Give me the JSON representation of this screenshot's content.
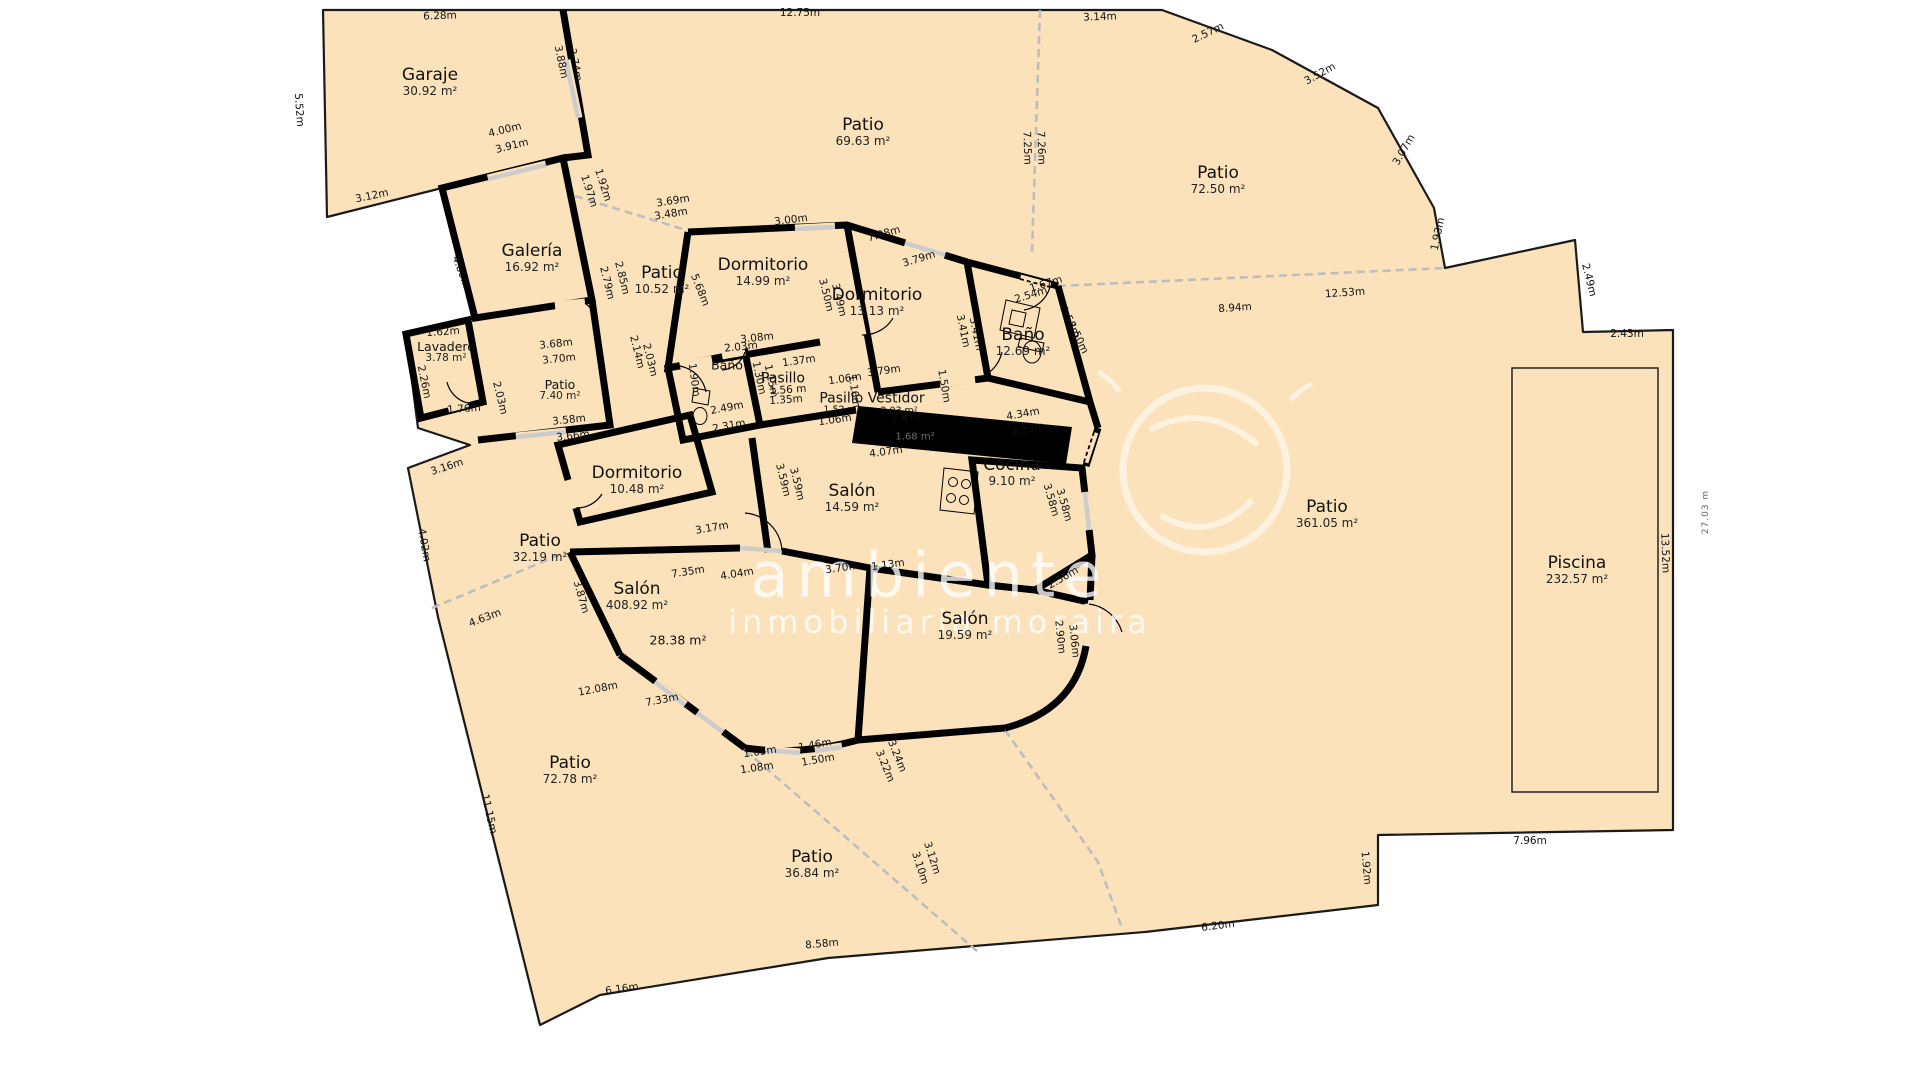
{
  "title": "floor-plan",
  "colors": {
    "parcel_fill": "#fbe2bb",
    "boundary": "#1a1a1a",
    "wall": "#000000",
    "divider_dashed": "#bdbdbd",
    "opening": "#cccccc",
    "watermark": "rgba(255,255,255,0.78)"
  },
  "watermark": {
    "line1": "ambiente",
    "line2": "inmobiliaria moraira"
  },
  "side_ruler": "27.03 m",
  "rooms": [
    {
      "name": "Garaje",
      "area": "30.92 m²",
      "x": 430,
      "y": 82,
      "s": ""
    },
    {
      "name": "Patio",
      "area": "69.63 m²",
      "x": 863,
      "y": 132,
      "s": ""
    },
    {
      "name": "Patio",
      "area": "72.50 m²",
      "x": 1218,
      "y": 180,
      "s": ""
    },
    {
      "name": "Galería",
      "area": "16.92 m²",
      "x": 532,
      "y": 258,
      "s": ""
    },
    {
      "name": "Patio",
      "area": "10.52 m²",
      "x": 662,
      "y": 280,
      "s": ""
    },
    {
      "name": "Dormitorio",
      "area": "14.99 m²",
      "x": 763,
      "y": 272,
      "s": ""
    },
    {
      "name": "Dormitorio",
      "area": "13.13 m²",
      "x": 877,
      "y": 302,
      "s": ""
    },
    {
      "name": "Baño",
      "area": "12.69 m²",
      "x": 1023,
      "y": 342,
      "s": ""
    },
    {
      "name": "Lavadero",
      "area": "3.78 m²",
      "x": 446,
      "y": 352,
      "s": "sm"
    },
    {
      "name": "Patio",
      "area": "7.40 m²",
      "x": 560,
      "y": 390,
      "s": "sm"
    },
    {
      "name": "Baño",
      "area": "",
      "x": 727,
      "y": 365,
      "s": "sm"
    },
    {
      "name": "Pasillo",
      "area": "",
      "x": 783,
      "y": 379,
      "s": "md"
    },
    {
      "name": "Pasillo Vestidor",
      "area": "",
      "x": 872,
      "y": 399,
      "s": "md"
    },
    {
      "name": "Dormitorio",
      "area": "10.48 m²",
      "x": 637,
      "y": 480,
      "s": ""
    },
    {
      "name": "Salón",
      "area": "14.59 m²",
      "x": 852,
      "y": 498,
      "s": ""
    },
    {
      "name": "Cocina",
      "area": "9.10 m²",
      "x": 1012,
      "y": 472,
      "s": ""
    },
    {
      "name": "Salón",
      "area": "19.59 m²",
      "x": 965,
      "y": 626,
      "s": ""
    },
    {
      "name": "Salón",
      "area": "408.92 m²",
      "x": 637,
      "y": 596,
      "s": ""
    },
    {
      "name": "Patio",
      "area": "32.19 m²",
      "x": 540,
      "y": 548,
      "s": ""
    },
    {
      "name": "Patio",
      "area": "72.78 m²",
      "x": 570,
      "y": 770,
      "s": ""
    },
    {
      "name": "Patio",
      "area": "36.84 m²",
      "x": 812,
      "y": 864,
      "s": ""
    },
    {
      "name": "Patio",
      "area": "361.05 m²",
      "x": 1327,
      "y": 514,
      "s": ""
    },
    {
      "name": "Piscina",
      "area": "232.57 m²",
      "x": 1577,
      "y": 570,
      "s": ""
    }
  ],
  "dims": [
    [
      "6.28m",
      440,
      16,
      -2,
      ""
    ],
    [
      "12.75m",
      800,
      13,
      0,
      ""
    ],
    [
      "3.14m",
      1100,
      17,
      -2,
      ""
    ],
    [
      "2.57m",
      1208,
      33,
      -26,
      ""
    ],
    [
      "3.52m",
      1320,
      74,
      -29,
      ""
    ],
    [
      "3.07m",
      1404,
      150,
      -60,
      ""
    ],
    [
      "1.93m",
      1438,
      234,
      -78,
      ""
    ],
    [
      "7.25m",
      1027,
      148,
      88,
      ""
    ],
    [
      "7.26m",
      1041,
      148,
      88,
      ""
    ],
    [
      "5.52m",
      299,
      110,
      86,
      ""
    ],
    [
      "3.12m",
      372,
      196,
      -12,
      ""
    ],
    [
      "3.88m",
      561,
      62,
      78,
      ""
    ],
    [
      "3.74m",
      575,
      65,
      78,
      ""
    ],
    [
      "4.00m",
      505,
      130,
      -14,
      ""
    ],
    [
      "3.91m",
      512,
      146,
      -14,
      ""
    ],
    [
      "1.92m",
      603,
      185,
      72,
      ""
    ],
    [
      "1.97m",
      589,
      191,
      72,
      ""
    ],
    [
      "3.69m",
      673,
      201,
      -9,
      ""
    ],
    [
      "3.48m",
      671,
      214,
      -9,
      ""
    ],
    [
      "4.80m",
      461,
      272,
      70,
      ""
    ],
    [
      "2.85m",
      622,
      278,
      76,
      ""
    ],
    [
      "2.79m",
      607,
      283,
      76,
      ""
    ],
    [
      "1.62m",
      443,
      332,
      -4,
      ""
    ],
    [
      "2.26m",
      424,
      382,
      78,
      ""
    ],
    [
      "1.76m",
      464,
      409,
      -4,
      ""
    ],
    [
      "2.03m",
      500,
      398,
      76,
      ""
    ],
    [
      "3.68m",
      556,
      344,
      -6,
      ""
    ],
    [
      "3.70m",
      559,
      359,
      -6,
      ""
    ],
    [
      "3.58m",
      569,
      420,
      -6,
      ""
    ],
    [
      "3.66m",
      573,
      436,
      -6,
      ""
    ],
    [
      "2.14m",
      637,
      352,
      76,
      ""
    ],
    [
      "2.03m",
      650,
      360,
      76,
      ""
    ],
    [
      "2.49m",
      727,
      408,
      -11,
      ""
    ],
    [
      "2.31m",
      729,
      426,
      -11,
      ""
    ],
    [
      "5.68m",
      700,
      290,
      68,
      ""
    ],
    [
      "3.00m",
      791,
      220,
      -7,
      ""
    ],
    [
      "7.98m",
      884,
      234,
      -16,
      ""
    ],
    [
      "3.79m",
      919,
      259,
      -17,
      ""
    ],
    [
      "3.50m",
      826,
      295,
      76,
      ""
    ],
    [
      "3.49m",
      839,
      300,
      76,
      ""
    ],
    [
      "3.08m",
      757,
      338,
      -6,
      ""
    ],
    [
      "2.03m",
      741,
      347,
      -6,
      ""
    ],
    [
      "1.90m",
      694,
      380,
      82,
      ""
    ],
    [
      "1.37m",
      799,
      361,
      -8,
      ""
    ],
    [
      "1.30m",
      759,
      378,
      78,
      ""
    ],
    [
      "1.15m",
      771,
      381,
      78,
      ""
    ],
    [
      "1.56 m",
      788,
      390,
      -4,
      ""
    ],
    [
      "1.35m",
      786,
      400,
      -4,
      ""
    ],
    [
      "1.16m",
      854,
      391,
      82,
      ""
    ],
    [
      "3.41m",
      963,
      331,
      78,
      ""
    ],
    [
      "3.41m",
      976,
      334,
      78,
      ""
    ],
    [
      "1.67m",
      1046,
      284,
      -17,
      ""
    ],
    [
      "2.54m",
      1031,
      295,
      -17,
      ""
    ],
    [
      "1.58m",
      1070,
      322,
      64,
      ""
    ],
    [
      "1.50m",
      1078,
      338,
      64,
      ""
    ],
    [
      "1.50m",
      944,
      386,
      80,
      ""
    ],
    [
      "4.34m",
      1023,
      414,
      -10,
      ""
    ],
    [
      "2.53m",
      1028,
      429,
      -10,
      ""
    ],
    [
      "3.79m",
      884,
      371,
      -8,
      ""
    ],
    [
      "1.06m",
      845,
      379,
      -8,
      ""
    ],
    [
      "1.06m",
      835,
      420,
      -8,
      ""
    ],
    [
      "2.87m",
      908,
      417,
      -8,
      ""
    ],
    [
      "4.07m",
      886,
      452,
      -8,
      ""
    ],
    [
      "3.59m",
      783,
      480,
      76,
      ""
    ],
    [
      "3.59m",
      797,
      484,
      76,
      ""
    ],
    [
      "3.17m",
      712,
      528,
      -10,
      ""
    ],
    [
      "2.56m",
      1063,
      578,
      -30,
      ""
    ],
    [
      "3.70m",
      842,
      568,
      -8,
      ""
    ],
    [
      "1.13m",
      888,
      565,
      -8,
      ""
    ],
    [
      "3.58m",
      1051,
      500,
      74,
      ""
    ],
    [
      "3.58m",
      1064,
      505,
      74,
      ""
    ],
    [
      "2.90m",
      1060,
      637,
      84,
      ""
    ],
    [
      "3.06m",
      1074,
      641,
      84,
      ""
    ],
    [
      "7.35m",
      688,
      572,
      -9,
      ""
    ],
    [
      "4.04m",
      737,
      574,
      -9,
      ""
    ],
    [
      "3.87m",
      581,
      597,
      74,
      ""
    ],
    [
      "4.63m",
      485,
      618,
      -21,
      ""
    ],
    [
      "3.16m",
      447,
      467,
      -18,
      ""
    ],
    [
      "4.02m",
      424,
      545,
      80,
      ""
    ],
    [
      "12.08m",
      598,
      689,
      -11,
      ""
    ],
    [
      "7.33m",
      662,
      700,
      -11,
      ""
    ],
    [
      "11.15m",
      489,
      814,
      77,
      ""
    ],
    [
      "6.16m",
      622,
      989,
      -8,
      ""
    ],
    [
      "8.58m",
      822,
      944,
      -5,
      ""
    ],
    [
      "1.05m",
      760,
      752,
      -8,
      ""
    ],
    [
      "1.08m",
      757,
      768,
      -8,
      ""
    ],
    [
      "1.46m",
      815,
      745,
      -10,
      ""
    ],
    [
      "1.50m",
      818,
      760,
      -10,
      ""
    ],
    [
      "3.24m",
      897,
      756,
      68,
      ""
    ],
    [
      "3.22m",
      885,
      766,
      68,
      ""
    ],
    [
      "3.12m",
      932,
      858,
      72,
      ""
    ],
    [
      "3.10m",
      920,
      868,
      72,
      ""
    ],
    [
      "6.20m",
      1218,
      926,
      -7,
      ""
    ],
    [
      "1.92m",
      1366,
      868,
      85,
      ""
    ],
    [
      "7.96m",
      1530,
      841,
      0,
      ""
    ],
    [
      "13.52m",
      1665,
      553,
      88,
      ""
    ],
    [
      "2.43m",
      1627,
      334,
      0,
      ""
    ],
    [
      "2.49m",
      1589,
      280,
      76,
      ""
    ],
    [
      "8.94m",
      1235,
      308,
      -4,
      ""
    ],
    [
      "12.53m",
      1345,
      293,
      -4,
      ""
    ],
    [
      "28.38 m²",
      678,
      640,
      0,
      "sm2"
    ],
    [
      "1.52 m²",
      842,
      410,
      0,
      "sm"
    ],
    [
      "2.03 m²",
      899,
      411,
      0,
      "sm"
    ],
    [
      "1.68 m²",
      915,
      437,
      0,
      "dk"
    ]
  ]
}
